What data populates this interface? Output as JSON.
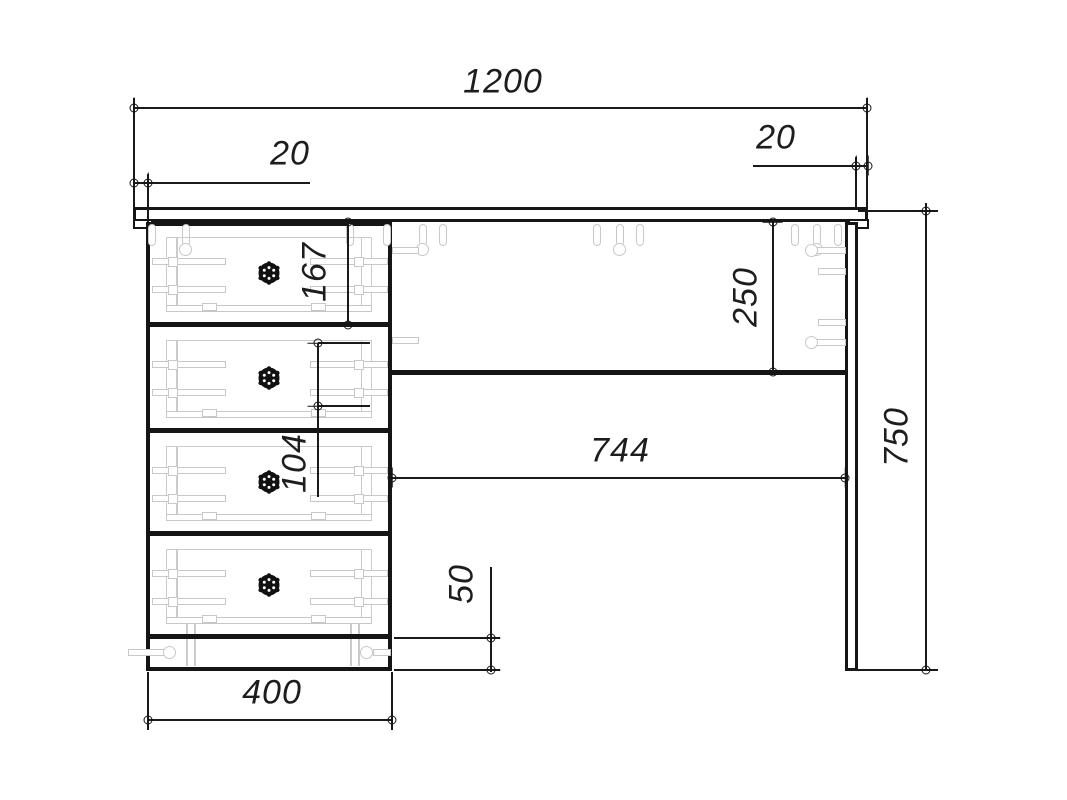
{
  "drawing": {
    "kind": "furniture-dimension-diagram",
    "subject": "desk-with-four-drawer-pedestal",
    "dims": {
      "w1200": "1200",
      "left20": "20",
      "right20": "20",
      "h167": "167",
      "h104": "104",
      "h250": "250",
      "w744": "744",
      "h750": "750",
      "h50": "50",
      "w400": "400"
    },
    "colors": {
      "line": "#1a1a1a",
      "bold_line": "#151515",
      "hardware": "#c8c8c8",
      "background": "#ffffff"
    },
    "icons": {
      "terminator": "circle-with-tick-marker",
      "knob": "drawer-knob"
    }
  }
}
